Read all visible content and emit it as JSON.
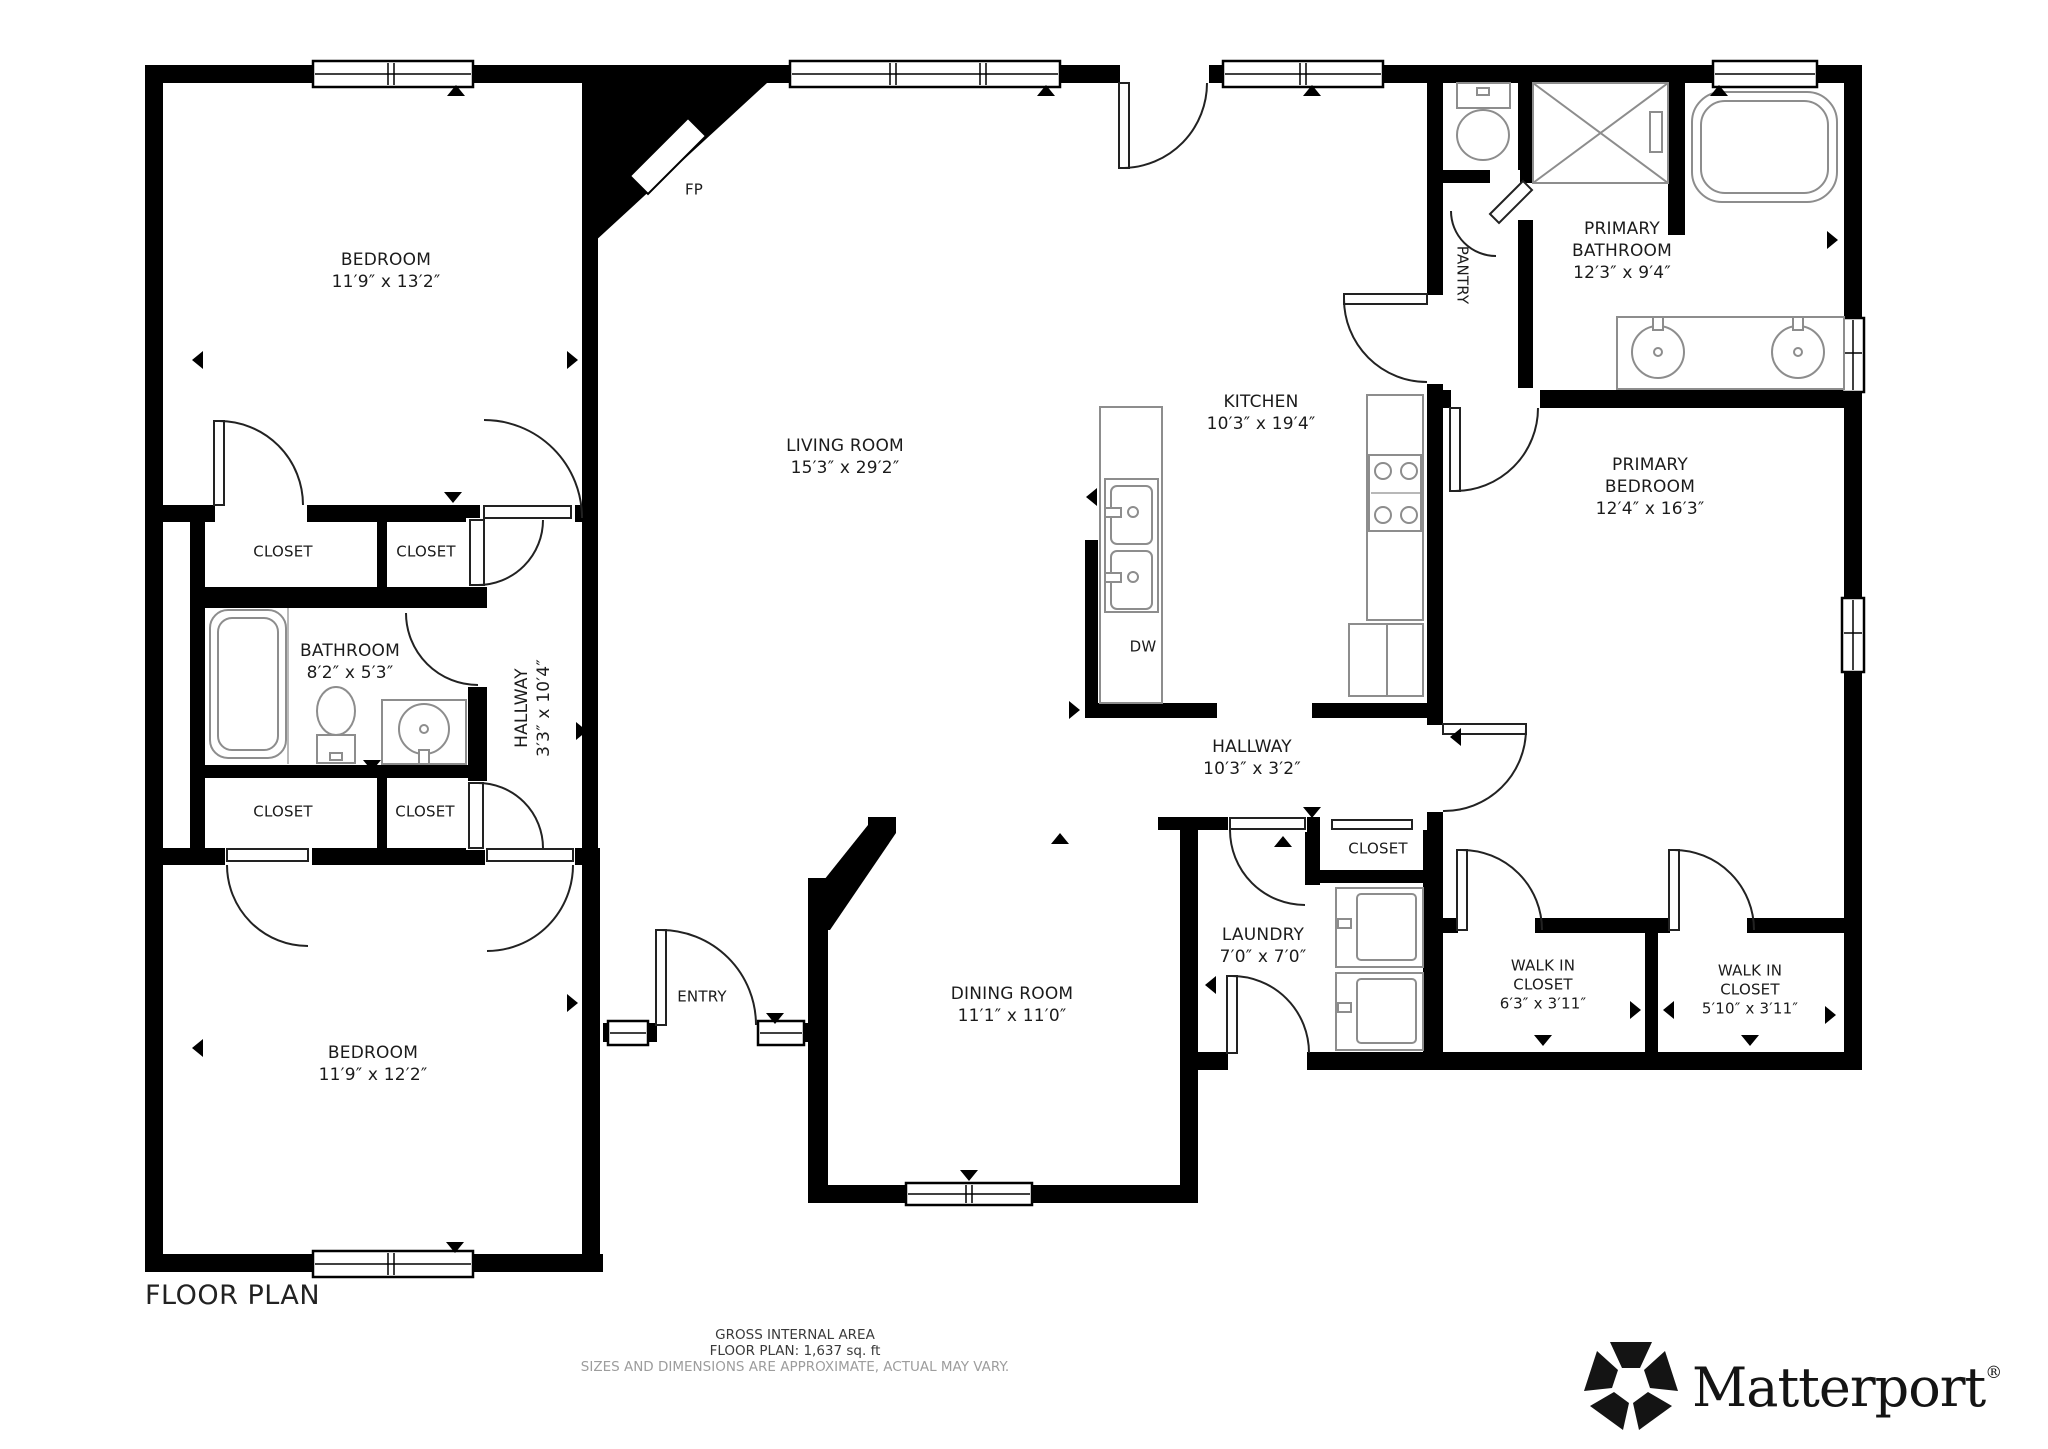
{
  "title": "FLOOR PLAN",
  "footer": {
    "line1": "GROSS INTERNAL AREA",
    "line2": "FLOOR PLAN: 1,637 sq. ft",
    "line3": "SIZES AND DIMENSIONS ARE APPROXIMATE, ACTUAL MAY VARY."
  },
  "brand": {
    "name": "Matterport",
    "registered": "®"
  },
  "colors": {
    "wall": "#000000",
    "door_arc": "#222222",
    "fixture": "#8d8d8d",
    "label": "#1b1b1b",
    "muted": "#9d9d9d"
  },
  "rooms": [
    {
      "id": "bedroom-1",
      "name": "BEDROOM",
      "dims": "11′9″ x 13′2″",
      "x": 386,
      "y": 271
    },
    {
      "id": "living-room",
      "name": "LIVING ROOM",
      "dims": "15′3″ x 29′2″",
      "x": 845,
      "y": 457
    },
    {
      "id": "kitchen",
      "name": "KITCHEN",
      "dims": "10′3″ x 19′4″",
      "x": 1261,
      "y": 413
    },
    {
      "id": "primary-bathroom",
      "name": "PRIMARY\nBATHROOM",
      "dims": "12′3″ x 9′4″",
      "x": 1622,
      "y": 251
    },
    {
      "id": "pantry",
      "name": "PANTRY",
      "dims": "",
      "x": 1462,
      "y": 275,
      "rot": "cw",
      "small": true
    },
    {
      "id": "primary-bedroom",
      "name": "PRIMARY\nBEDROOM",
      "dims": "12′4″ x 16′3″",
      "x": 1650,
      "y": 487
    },
    {
      "id": "closet-1",
      "name": "CLOSET",
      "dims": "",
      "x": 283,
      "y": 552,
      "small": true
    },
    {
      "id": "closet-2",
      "name": "CLOSET",
      "dims": "",
      "x": 426,
      "y": 552,
      "small": true
    },
    {
      "id": "bathroom",
      "name": "BATHROOM",
      "dims": "8′2″ x 5′3″",
      "x": 350,
      "y": 662
    },
    {
      "id": "hallway-1",
      "name": "HALLWAY",
      "dims": "3′3″ x 10′4″",
      "x": 533,
      "y": 708,
      "rot": "ccw"
    },
    {
      "id": "closet-3",
      "name": "CLOSET",
      "dims": "",
      "x": 283,
      "y": 812,
      "small": true
    },
    {
      "id": "closet-4",
      "name": "CLOSET",
      "dims": "",
      "x": 425,
      "y": 812,
      "small": true
    },
    {
      "id": "bedroom-2",
      "name": "BEDROOM",
      "dims": "11′9″ x 12′2″",
      "x": 373,
      "y": 1064
    },
    {
      "id": "entry",
      "name": "ENTRY",
      "dims": "",
      "x": 702,
      "y": 997,
      "small": true
    },
    {
      "id": "dining-room",
      "name": "DINING ROOM",
      "dims": "11′1″ x 11′0″",
      "x": 1012,
      "y": 1005
    },
    {
      "id": "hallway-2",
      "name": "HALLWAY",
      "dims": "10′3″ x 3′2″",
      "x": 1252,
      "y": 758
    },
    {
      "id": "closet-5",
      "name": "CLOSET",
      "dims": "",
      "x": 1378,
      "y": 849,
      "small": true
    },
    {
      "id": "laundry",
      "name": "LAUNDRY",
      "dims": "7′0″ x 7′0″",
      "x": 1263,
      "y": 946
    },
    {
      "id": "walk-in-closet-1",
      "name": "WALK IN\nCLOSET",
      "dims": "6′3″ x 3′11″",
      "x": 1543,
      "y": 985,
      "small": true
    },
    {
      "id": "walk-in-closet-2",
      "name": "WALK IN\nCLOSET",
      "dims": "5′10″ x 3′11″",
      "x": 1750,
      "y": 990,
      "small": true
    },
    {
      "id": "fireplace",
      "name": "FP",
      "dims": "",
      "x": 694,
      "y": 190,
      "small": true
    },
    {
      "id": "dishwasher",
      "name": "DW",
      "dims": "",
      "x": 1143,
      "y": 647,
      "small": true
    }
  ]
}
